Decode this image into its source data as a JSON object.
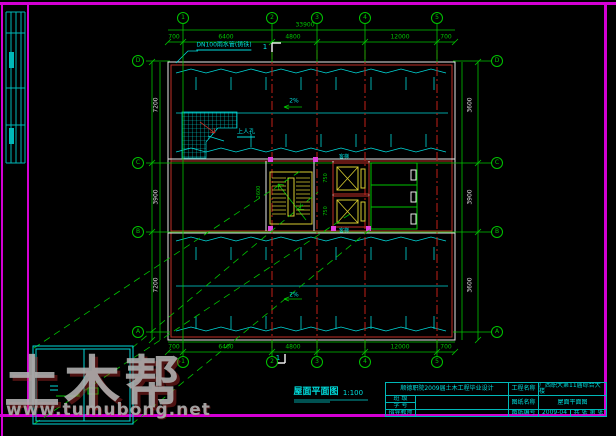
{
  "watermark": {
    "text": "土木帮",
    "url": "www.tumubong.net"
  },
  "plan": {
    "title": "屋面平面图",
    "scale": "1:100",
    "labels": {
      "rain_pipe": "DN100雨水管(铸铁)",
      "hatch": "上人孔",
      "slope_top": "2%",
      "slope_bottom": "2%",
      "elevator_top": "客梯",
      "elevator_bottom": "客梯",
      "stair_up": "上",
      "section_top": "1",
      "section_bottom": "1"
    }
  },
  "axes": {
    "top": [
      "1",
      "2",
      "3",
      "4",
      "5"
    ],
    "bottom": [
      "1",
      "2",
      "3",
      "4",
      "5"
    ],
    "left": [
      "D",
      "C",
      "B",
      "A"
    ],
    "right": [
      "D",
      "C",
      "B",
      "A"
    ]
  },
  "dims": {
    "top": [
      "700",
      "6400",
      "4800",
      "12000",
      "700"
    ],
    "top_total": "33900",
    "bottom": [
      "700",
      "6400",
      "4800",
      "12000",
      "700"
    ],
    "left": [
      "7200",
      "3900",
      "7200"
    ],
    "right": [
      "3600",
      "3900",
      "3600"
    ],
    "core": [
      "2600",
      "750",
      "750"
    ]
  },
  "title_block": {
    "school": "顺德职院2009届土木工程毕业设计",
    "project_label": "工程名称",
    "project_name": "广西职大第11届综合大楼",
    "class_label": "班  级",
    "student_label": "学  号",
    "advisor_label": "指导教师",
    "sheetname_label": "图纸名称",
    "sheet_name": "屋面平面图",
    "sheetno_label": "图纸编号",
    "sheet_no": "2009-04",
    "pages": "共 张 第 张"
  }
}
